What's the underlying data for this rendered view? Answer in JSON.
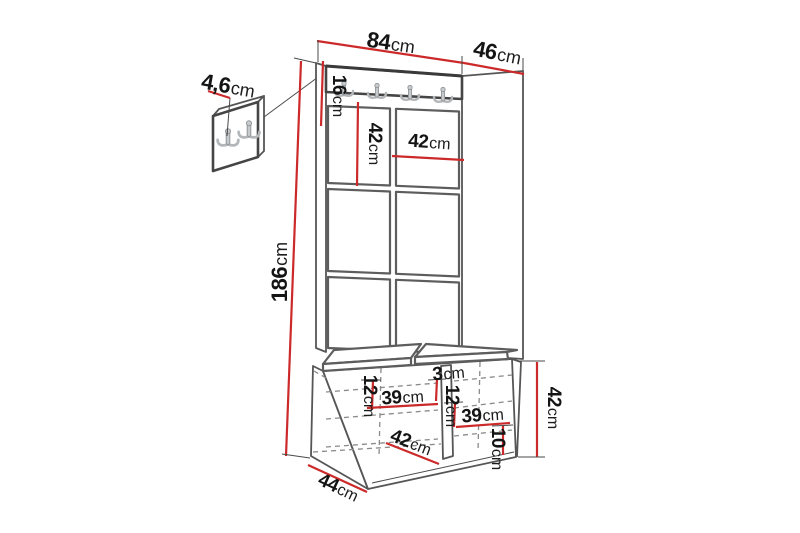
{
  "colors": {
    "dimension_line": "#cc2a2a",
    "outline": "#565656",
    "hidden_line": "#8a8a8a",
    "text": "#141414"
  },
  "dimensions": {
    "top_width": {
      "num": "84",
      "unit": "cm"
    },
    "top_depth": {
      "num": "46",
      "unit": "cm"
    },
    "hook_height": {
      "num": "4,6",
      "unit": "cm"
    },
    "rail_height": {
      "num": "16",
      "unit": "cm"
    },
    "tile_height": {
      "num": "42",
      "unit": "cm"
    },
    "tile_width": {
      "num": "42",
      "unit": "cm"
    },
    "total_height": {
      "num": "186",
      "unit": "cm"
    },
    "divider_thickness": {
      "num": "3",
      "unit": "cm"
    },
    "shelf_gap_left": {
      "num": "12",
      "unit": "cm"
    },
    "shelf_gap_right": {
      "num": "12",
      "unit": "cm"
    },
    "compartment_left": {
      "num": "39",
      "unit": "cm"
    },
    "compartment_right": {
      "num": "39",
      "unit": "cm"
    },
    "bench_inner_depth": {
      "num": "42",
      "unit": "cm"
    },
    "plinth_height": {
      "num": "10",
      "unit": "cm"
    },
    "bench_height": {
      "num": "42",
      "unit": "cm"
    },
    "bench_depth": {
      "num": "44",
      "unit": "cm"
    }
  }
}
